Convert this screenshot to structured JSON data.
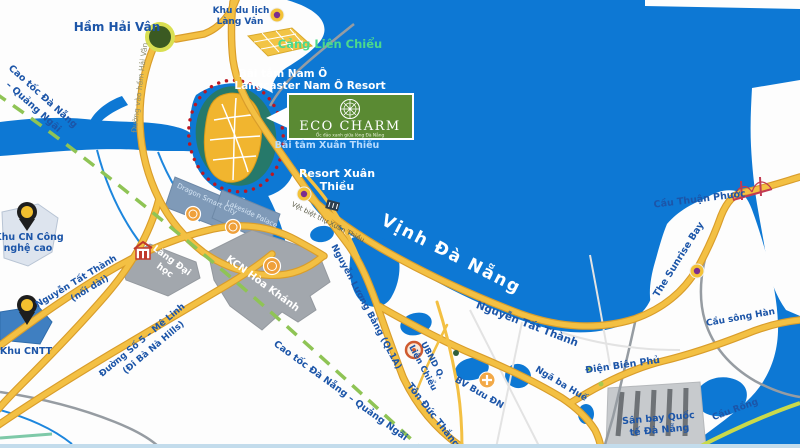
{
  "colors": {
    "sea": "#0d78d4",
    "road_yellow": "#f3c043",
    "road_casing": "#d99d2b",
    "label_blue": "#1c55a8",
    "green_dash": "#8fc455",
    "lime_road": "#c9d94b",
    "zone_gray": "#a2a7ad",
    "zone_bluegray": "#7f9ab8",
    "island_yellow": "#f1b52f",
    "island_teal": "#26796a",
    "red_dotted_border": "#bb1722",
    "eco_logo_green": "#5a8a33",
    "pin_yellow": "#f3c02f",
    "poi_orange": "#efa03b",
    "port_green_text": "#4cd98c"
  },
  "logo": {
    "title": "ECO CHARM",
    "tagline": "Ốc đảo xanh giữa lòng Đà Nẵng"
  },
  "labels": {
    "ham_hai_van": "Hầm Hải Vân",
    "duong_vao_ham_hai_van": "Đường vào hầm Hải Vân",
    "khu_du_lich_line1": "Khu du lịch",
    "khu_du_lich_line2": "Làng Vân",
    "cang_lien_chieu": "Cảng Liên Chiểu",
    "bai_tam_nam_o": "Bãi tắm Nam Ô",
    "langcaster": "Langcaster  Nam Ô Resort",
    "bai_tam_xuan_thieu": "Bãi tắm Xuân Thiều",
    "resort_xuan_thieu_line1": "Resort Xuân",
    "resort_xuan_thieu_line2": "Thiều",
    "vinh_da_nang": "Vịnh Đà Nẵng",
    "cau_thuan_phuoc": "Cầu Thuận Phước",
    "the_sunrise_bay": "The Sunrise Bay",
    "cau_song_han": "Cầu sông Hàn",
    "cau_rong": "Cầu Rồng",
    "nguyen_tat_thanh": "Nguyễn Tất Thành",
    "ntt_noi_dai_line1": "Nguyễn Tất Thành",
    "ntt_noi_dai_line2": "(nối dài)",
    "nguyen_luong_bang": "Nguyễn Lương Bằng (QL1A)",
    "duong_so_5_line1": "Đường Số 5 – Mê Linh",
    "duong_so_5_line2": "(Đi Bà Nà Hills)",
    "cao_toc_line1": "Cao tốc Đà Nẵng",
    "cao_toc_line2": "– Quảng Ngãi",
    "cao_toc_full": "Cao tốc Đà Nẵng – Quảng Ngãi",
    "ton_duc_thang": "Tôn Đức Thắng",
    "ubnd_line1": "UBND Q.",
    "ubnd_line2": "Liên Chiểu",
    "bv_buu_dn": "BV Bưu ĐN",
    "nga_ba_hue": "Ngã ba Huế",
    "dien_bien_phu": "Điện Biên Phủ",
    "san_bay_line1": "Sân bay Quốc",
    "san_bay_line2": "tế Đà Nẵng",
    "kcn_hoa_khanh": "KCN Hòa Khánh",
    "lang_dai_hoc_line1": "Làng Đại",
    "lang_dai_hoc_line2": "học",
    "khu_cn_line1": "Khu CN Công",
    "khu_cn_line2": "nghệ cao",
    "khu_cntt": "Khu CNTT",
    "vet_biet_thu": "Vệt biệt thự Xuân Thiều",
    "dragon_smart_city": "Dragon Smart City",
    "lakeside_palace": "Lakeside Palace"
  }
}
